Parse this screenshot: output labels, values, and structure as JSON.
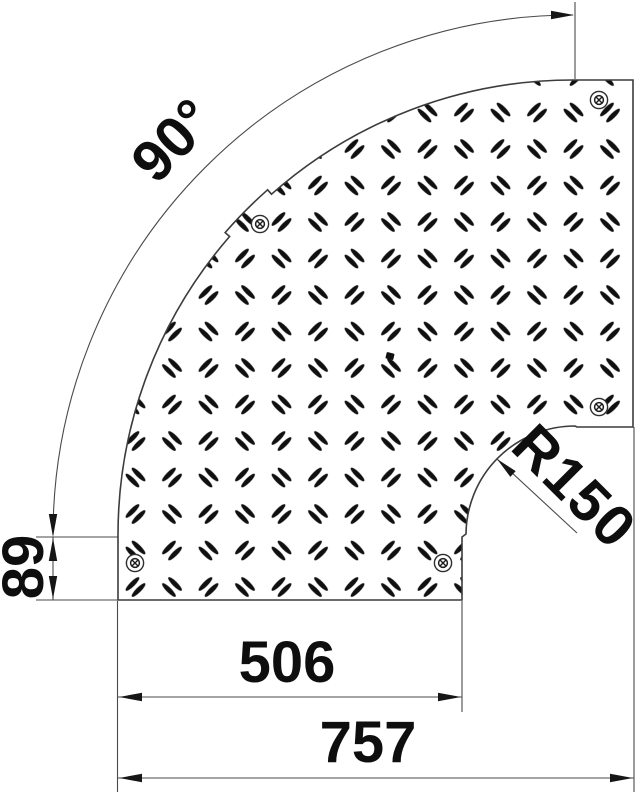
{
  "drawing": {
    "kind": "technical dimension drawing",
    "subject": "90-degree flat bend cover with tread-plate pattern",
    "background_color": "#ffffff",
    "line_color": "#3c3c3c",
    "text_color": "#0e0e0e",
    "labels": {
      "angle": "90°",
      "radius": "R150",
      "height": "89",
      "inner_width": "506",
      "total_width": "757"
    },
    "icons": {
      "screw": "screw-head-icon",
      "arrow": "dimension-arrow-icon"
    },
    "screw_count": 5
  }
}
